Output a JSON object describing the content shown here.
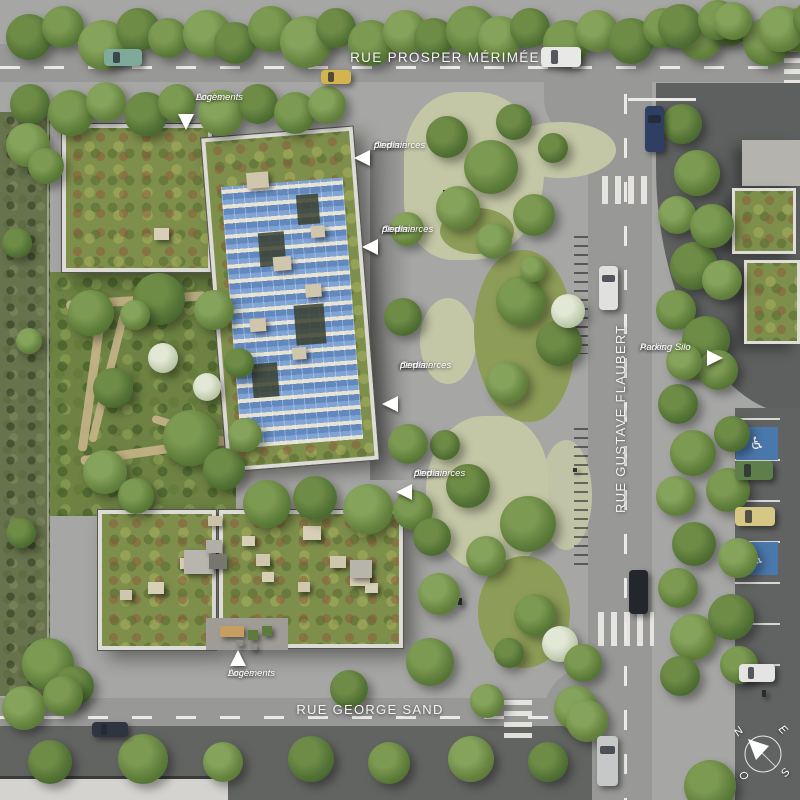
{
  "scene": {
    "kind": "aerial-site-plan-render",
    "streets": {
      "prosper_merimee": "RUE PROSPER MÉRIMÉE",
      "gustave_flaubert": "RUE GUSTAVE FLAUBERT",
      "george_sand": "RUE GEORGE SAND"
    },
    "annotations": {
      "acces_logements": {
        "lines": [
          "Accès",
          "Logements"
        ]
      },
      "acces_commerces": {
        "lines": [
          "Accès",
          "Commerces",
          "de plain",
          "pied"
        ]
      },
      "acces_parking_silo": {
        "lines": [
          "Accès",
          "Parking Silo"
        ]
      }
    },
    "compass": {
      "n": "N",
      "e": "E",
      "s": "S",
      "o": "O"
    },
    "colors": {
      "road_gray": "#989896",
      "plaza_gray": "#a6a6a4",
      "asphalt_dark": "#5e605f",
      "sedum_green": "#7e8e4b",
      "solar_panel_blue": "#7fa3d4",
      "handicap_bay_blue": "#4a78ac",
      "label_white": "#ffffff"
    }
  }
}
